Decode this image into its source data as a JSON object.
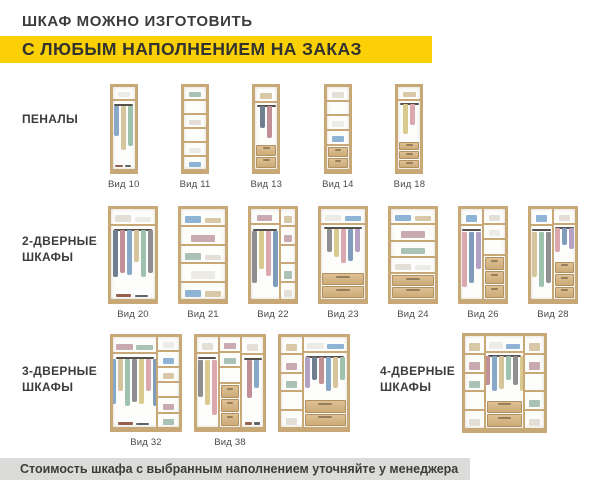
{
  "header": {
    "line1": "ШКАФ МОЖНО ИЗГОТОВИТЬ",
    "line2": "С ЛЮБЫМ НАПОЛНЕНИЕМ НА ЗАКАЗ"
  },
  "footer": {
    "note": "Стоимость шкафа с выбранным наполнением уточняйте у менеджера"
  },
  "colors": {
    "accent_yellow": "#FBD106",
    "footer_bg": "#DBDBD9",
    "text_dark": "#3C3C3A",
    "label_gray": "#4B4B49",
    "wood": "#C9A877",
    "wood_light": "#DDC094"
  },
  "palette": {
    "garments": [
      "#C38F96",
      "#87A9C7",
      "#D6C49C",
      "#9FC2AE",
      "#8F8F91",
      "#D9CA8F",
      "#DBA8B0",
      "#7F9CBB",
      "#B3A1C4",
      "#6F7F8F"
    ],
    "items": [
      "#ECEBE6",
      "#8FB3D4",
      "#D8C8A8",
      "#C9A9B2",
      "#A9C2B5",
      "#E3DFD6"
    ],
    "floor": [
      "#96604F",
      "#5F6468"
    ]
  },
  "sections": [
    {
      "label": "ПЕНАЛЫ",
      "cabinets": [
        {
          "label": "Вид 10",
          "cols": [
            {
              "w": 1,
              "z": [
                {
                  "t": "shelf",
                  "f": 1,
                  "i": 1
                },
                {
                  "t": "hang",
                  "f": 4.6,
                  "n": 3
                },
                {
                  "t": "open",
                  "f": 1,
                  "i": "shoes"
                }
              ]
            }
          ]
        },
        {
          "label": "Вид 11",
          "cols": [
            {
              "w": 1,
              "z": [
                {
                  "t": "shelf",
                  "f": 1,
                  "i": 1
                },
                {
                  "t": "shelf",
                  "f": 1,
                  "i": 0
                },
                {
                  "t": "shelf",
                  "f": 1,
                  "i": 1
                },
                {
                  "t": "shelf",
                  "f": 1,
                  "i": 0
                },
                {
                  "t": "shelf",
                  "f": 1,
                  "i": 1
                },
                {
                  "t": "shelf",
                  "f": 1,
                  "i": 1
                }
              ]
            }
          ]
        },
        {
          "label": "Вид 13",
          "cols": [
            {
              "w": 1,
              "z": [
                {
                  "t": "shelf",
                  "f": 1,
                  "i": 1
                },
                {
                  "t": "hang",
                  "f": 3,
                  "n": 2
                },
                {
                  "t": "drw",
                  "f": 1.7,
                  "n": 2
                }
              ]
            }
          ]
        },
        {
          "label": "Вид 14",
          "cols": [
            {
              "w": 1,
              "z": [
                {
                  "t": "shelf",
                  "f": 1,
                  "i": 1
                },
                {
                  "t": "shelf",
                  "f": 1,
                  "i": 0
                },
                {
                  "t": "shelf",
                  "f": 1,
                  "i": 1
                },
                {
                  "t": "shelf",
                  "f": 1,
                  "i": 1
                },
                {
                  "t": "drw",
                  "f": 1.7,
                  "n": 2
                }
              ]
            }
          ]
        },
        {
          "label": "Вид 18",
          "cols": [
            {
              "w": 1,
              "z": [
                {
                  "t": "shelf",
                  "f": 1,
                  "i": 1
                },
                {
                  "t": "hang",
                  "f": 3.4,
                  "n": 2
                },
                {
                  "t": "drw",
                  "f": 2.2,
                  "n": 3
                }
              ]
            }
          ]
        }
      ]
    },
    {
      "label": "2-ДВЕРНЫЕ ШКАФЫ",
      "cabinets": [
        {
          "label": "Вид 20",
          "cols": [
            {
              "w": 1,
              "z": [
                {
                  "t": "shelf",
                  "f": 1,
                  "i": 2
                },
                {
                  "t": "hang",
                  "f": 4,
                  "n": 6
                },
                {
                  "t": "open",
                  "f": 1,
                  "i": "shoes"
                }
              ]
            }
          ]
        },
        {
          "label": "Вид 21",
          "cols": [
            {
              "w": 1,
              "z": [
                {
                  "t": "shelf",
                  "f": 1,
                  "i": 2
                },
                {
                  "t": "shelf",
                  "f": 1,
                  "i": 1
                },
                {
                  "t": "shelf",
                  "f": 1,
                  "i": 2
                },
                {
                  "t": "shelf",
                  "f": 1,
                  "i": 1
                },
                {
                  "t": "shelf",
                  "f": 1,
                  "i": 2
                }
              ]
            }
          ]
        },
        {
          "label": "Вид 22",
          "cols": [
            {
              "w": 1.9,
              "z": [
                {
                  "t": "shelf",
                  "f": 1,
                  "i": 1
                },
                {
                  "t": "hang",
                  "f": 5.3,
                  "n": 4
                }
              ]
            },
            {
              "w": 1,
              "z": [
                {
                  "t": "shelf",
                  "f": 1,
                  "i": 1
                },
                {
                  "t": "shelf",
                  "f": 1,
                  "i": 1
                },
                {
                  "t": "shelf",
                  "f": 1,
                  "i": 0
                },
                {
                  "t": "shelf",
                  "f": 1,
                  "i": 1
                },
                {
                  "t": "shelf",
                  "f": 1,
                  "i": 1
                }
              ]
            }
          ]
        },
        {
          "label": "Вид 23",
          "cols": [
            {
              "w": 1,
              "z": [
                {
                  "t": "shelf",
                  "f": 1,
                  "i": 2
                },
                {
                  "t": "hang",
                  "f": 3.4,
                  "n": 5
                },
                {
                  "t": "drw",
                  "f": 1.8,
                  "n": 2
                }
              ]
            }
          ]
        },
        {
          "label": "Вид 24",
          "cols": [
            {
              "w": 1,
              "z": [
                {
                  "t": "shelf",
                  "f": 1,
                  "i": 2
                },
                {
                  "t": "shelf",
                  "f": 1,
                  "i": 1
                },
                {
                  "t": "shelf",
                  "f": 1,
                  "i": 1
                },
                {
                  "t": "shelf",
                  "f": 1,
                  "i": 2
                },
                {
                  "t": "drw",
                  "f": 1.6,
                  "n": 2
                }
              ]
            }
          ]
        },
        {
          "label": "Вид 26",
          "cols": [
            {
              "w": 1,
              "z": [
                {
                  "t": "shelf",
                  "f": 1,
                  "i": 1
                },
                {
                  "t": "hang",
                  "f": 5,
                  "n": 3
                }
              ]
            },
            {
              "w": 1,
              "z": [
                {
                  "t": "shelf",
                  "f": 1,
                  "i": 1
                },
                {
                  "t": "shelf",
                  "f": 1,
                  "i": 1
                },
                {
                  "t": "shelf",
                  "f": 1,
                  "i": 0
                },
                {
                  "t": "drw",
                  "f": 3,
                  "n": 3
                }
              ]
            }
          ]
        },
        {
          "label": "Вид 28",
          "cols": [
            {
              "w": 1,
              "z": [
                {
                  "t": "shelf",
                  "f": 1,
                  "i": 1
                },
                {
                  "t": "hang",
                  "f": 5,
                  "n": 3
                }
              ]
            },
            {
              "w": 1,
              "z": [
                {
                  "t": "shelf",
                  "f": 1,
                  "i": 1
                },
                {
                  "t": "hang",
                  "f": 2.6,
                  "n": 3
                },
                {
                  "t": "drw",
                  "f": 2.6,
                  "n": 3
                }
              ]
            }
          ]
        }
      ]
    },
    {
      "label": "3-ДВЕРНЫЕ ШКАФЫ",
      "cabinets": [
        {
          "label": "Вид 32",
          "cols": [
            {
              "w": 2.1,
              "z": [
                {
                  "t": "shelf",
                  "f": 1,
                  "i": 2
                },
                {
                  "t": "hang",
                  "f": 3.8,
                  "n": 7
                },
                {
                  "t": "open",
                  "f": 0.9,
                  "i": "shoes"
                }
              ]
            },
            {
              "w": 1,
              "z": [
                {
                  "t": "shelf",
                  "f": 1,
                  "i": 1
                },
                {
                  "t": "shelf",
                  "f": 1,
                  "i": 1
                },
                {
                  "t": "shelf",
                  "f": 1,
                  "i": 1
                },
                {
                  "t": "shelf",
                  "f": 1,
                  "i": 0
                },
                {
                  "t": "shelf",
                  "f": 1,
                  "i": 1
                },
                {
                  "t": "shelf",
                  "f": 1,
                  "i": 1
                }
              ]
            }
          ]
        },
        {
          "label": "Вид 38",
          "cols": [
            {
              "w": 1,
              "z": [
                {
                  "t": "shelf",
                  "f": 1,
                  "i": 1
                },
                {
                  "t": "hang",
                  "f": 5,
                  "n": 3
                }
              ]
            },
            {
              "w": 1,
              "z": [
                {
                  "t": "shelf",
                  "f": 1,
                  "i": 1
                },
                {
                  "t": "shelf",
                  "f": 1,
                  "i": 1
                },
                {
                  "t": "shelf",
                  "f": 1,
                  "i": 0
                },
                {
                  "t": "drw",
                  "f": 3,
                  "n": 3
                }
              ]
            },
            {
              "w": 1,
              "z": [
                {
                  "t": "shelf",
                  "f": 1,
                  "i": 1
                },
                {
                  "t": "hang",
                  "f": 3.4,
                  "n": 2
                },
                {
                  "t": "open",
                  "f": 1,
                  "i": "shoes"
                }
              ]
            }
          ]
        },
        {
          "label": "",
          "cols": [
            {
              "w": 1,
              "z": [
                {
                  "t": "shelf",
                  "f": 1,
                  "i": 1
                },
                {
                  "t": "shelf",
                  "f": 1,
                  "i": 1
                },
                {
                  "t": "shelf",
                  "f": 1,
                  "i": 1
                },
                {
                  "t": "shelf",
                  "f": 1,
                  "i": 0
                },
                {
                  "t": "shelf",
                  "f": 1,
                  "i": 1
                }
              ]
            },
            {
              "w": 2.1,
              "z": [
                {
                  "t": "shelf",
                  "f": 1,
                  "i": 2
                },
                {
                  "t": "hang",
                  "f": 3.2,
                  "n": 6
                },
                {
                  "t": "drw",
                  "f": 1.8,
                  "n": 2
                }
              ]
            }
          ]
        }
      ]
    },
    {
      "label": "4-ДВЕРНЫЕ ШКАФЫ",
      "cabinets": [
        {
          "label": "",
          "cols": [
            {
              "w": 1,
              "z": [
                {
                  "t": "shelf",
                  "f": 1,
                  "i": 1
                },
                {
                  "t": "shelf",
                  "f": 1,
                  "i": 1
                },
                {
                  "t": "shelf",
                  "f": 1,
                  "i": 1
                },
                {
                  "t": "shelf",
                  "f": 1,
                  "i": 0
                },
                {
                  "t": "shelf",
                  "f": 1,
                  "i": 1
                }
              ]
            },
            {
              "w": 2,
              "z": [
                {
                  "t": "shelf",
                  "f": 1,
                  "i": 2
                },
                {
                  "t": "hang",
                  "f": 3.2,
                  "n": 6
                },
                {
                  "t": "drw",
                  "f": 1.8,
                  "n": 2
                }
              ]
            },
            {
              "w": 1,
              "z": [
                {
                  "t": "shelf",
                  "f": 1,
                  "i": 1
                },
                {
                  "t": "shelf",
                  "f": 1,
                  "i": 1
                },
                {
                  "t": "shelf",
                  "f": 1,
                  "i": 0
                },
                {
                  "t": "shelf",
                  "f": 1,
                  "i": 1
                },
                {
                  "t": "shelf",
                  "f": 1,
                  "i": 1
                }
              ]
            }
          ]
        }
      ]
    }
  ]
}
